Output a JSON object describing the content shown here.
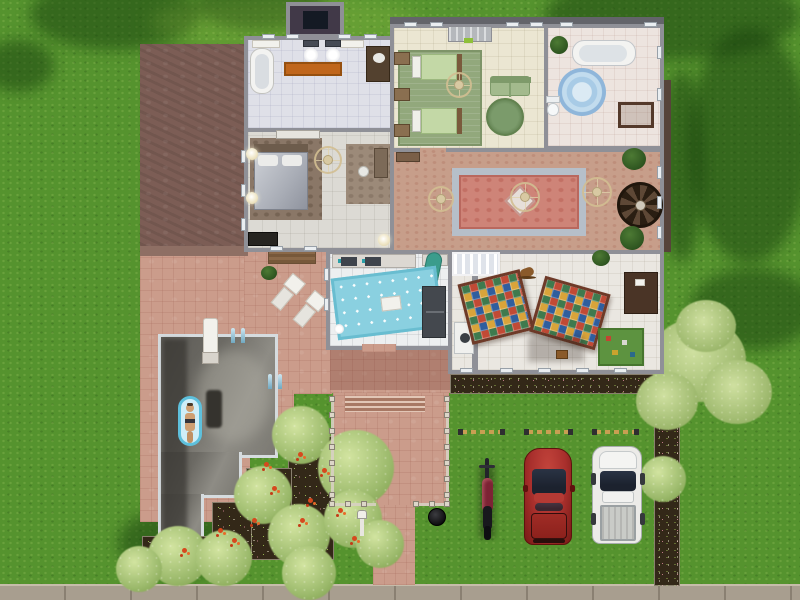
{
  "scene": {
    "type": "game-screenshot",
    "style": "life-simulation top-down lot view",
    "description": "suburban one-story house with pool, patio, flower gardens and grass driveway"
  },
  "colors": {
    "grass": "#55932e",
    "sidewalk": "#a89e8f",
    "patio": "#cb9c8b",
    "roof": "#7c5d55",
    "roofEdge": "#8e6f64",
    "wall": "#8f9097",
    "soil": "#332818",
    "bush": "#9cba6c",
    "bushLight": "#d2e4a0",
    "tree": "#a3bd73",
    "treeLight": "#cfe0a0",
    "poolWater": "#6c6a64",
    "coping": "#d6dcdf",
    "floatBlue": "#5ec0dc",
    "skin": "#cf9f72",
    "floorBath": "#dfe0e8",
    "floorBed": "#dcdad4",
    "floorGreen": "#ebe6d2",
    "floorBath2": "#ede4df",
    "carpet": "#c79e8a",
    "floorKitchen": "#edeff0",
    "floorPlay": "#eae7e1",
    "rugOrange": "#c0661c",
    "rugBedroom": "#8a7767",
    "rugGreen": "#92a87c",
    "rugRound": "#7b9b6b",
    "bedGreen": "#c3d8a6",
    "sofaGreen": "#a3ba8d",
    "rugBlue": "#a9cbe5",
    "rugRose": "#ce8478",
    "rugRoseBorder": "#b6bfc9",
    "rugKitchen": "#8ad0e0",
    "rugA1": "#c14a35",
    "rugA2": "#2f5e9e",
    "rugA3": "#d9a43a",
    "rugA4": "#3f7a4e",
    "matGreen": "#5d9340",
    "fridge": "#44484e",
    "wood": "#8a6f50",
    "woodDark": "#4a3426",
    "fanGold": "#d8c9a2",
    "marker": "#c89f52",
    "carRed": "#a82f2c",
    "carRedHi": "#c4453c",
    "glass": "#1c222e",
    "truck": "#ecebe8",
    "moto": "#7c2334"
  },
  "yard": {
    "ground": "grass lawn with tree shadows",
    "sidewalk": "concrete sidewalk along bottom edge",
    "flower_garden": "stepped dark soil beds with red and white flowers and pale green bushes",
    "flower_bed_south": "narrow bed below playroom wall",
    "flower_bed_east": "narrow bed along driveway with small tree",
    "tree": "pale green tree at east flower bed"
  },
  "pool": {
    "water": "grey reflective water",
    "features": [
      "diving-board",
      "pool-ladder",
      "pool-ladder",
      "pool-float-with-sim"
    ]
  },
  "patio": {
    "furniture": [
      "picnic-table",
      "chaise-lounge",
      "chaise-lounge",
      "potted-plant"
    ],
    "porch": {
      "features": [
        "fence-posts",
        "steps",
        "mailbox",
        "trash-can",
        "path-to-sidewalk"
      ]
    }
  },
  "house": {
    "roof": "mauve flat garage roof, north-west wing",
    "chimney": "slate chimney at top wall",
    "entry_stoop": "small railed stoop on north wall with green doormat",
    "rooms": [
      {
        "id": "master-bathroom",
        "furniture": [
          "clawfoot-tub",
          "pedestal-sink",
          "pedestal-sink",
          "orange-runner-rug",
          "wood-vanity",
          "wall-cabinets"
        ]
      },
      {
        "id": "master-bedroom",
        "furniture": [
          "double-bed",
          "area-rug",
          "ceiling-fan",
          "desk",
          "desk-chair",
          "desk-rug",
          "dresser",
          "wall-lamps",
          "dark-chest"
        ]
      },
      {
        "id": "kids-bedroom",
        "furniture": [
          "twin-bed",
          "twin-bed",
          "nightstand",
          "nightstand",
          "nightstand",
          "green-area-rug",
          "round-green-rug",
          "green-loveseat",
          "ceiling-fan"
        ]
      },
      {
        "id": "bathroom",
        "furniture": [
          "clawfoot-tub",
          "round-blue-rug",
          "toilet",
          "towel-table",
          "potted-plant"
        ]
      },
      {
        "id": "living-room",
        "furniture": [
          "oriental-rug",
          "ceiling-fan",
          "ceiling-fan",
          "ceiling-fan",
          "spiral-staircase",
          "potted-plant",
          "potted-plant",
          "bookshelf"
        ]
      },
      {
        "id": "kitchen",
        "furniture": [
          "counter-with-sinks",
          "counter",
          "blue-polka-dot-rug",
          "refrigerator",
          "ironing-board",
          "pet-bowl"
        ]
      },
      {
        "id": "playroom",
        "furniture": [
          "crib",
          "washing-machine",
          "alphabet-block-rug",
          "alphabet-block-rug",
          "rocking-horse",
          "activity-desk",
          "toy-play-mat",
          "potted-plant",
          "wooden-toy"
        ]
      }
    ]
  },
  "driveway": {
    "parking_space_count": 3,
    "vehicles": [
      {
        "type": "motorcycle",
        "color": "#7c2334"
      },
      {
        "type": "car",
        "color": "#a82f2c"
      },
      {
        "type": "pickup-truck",
        "color": "#ecebe8"
      }
    ]
  }
}
